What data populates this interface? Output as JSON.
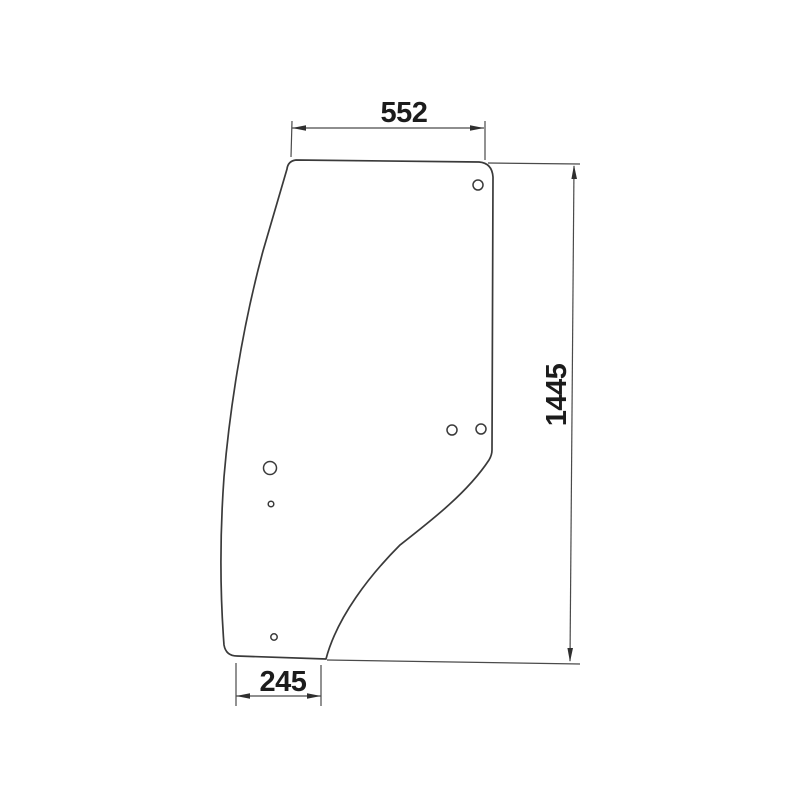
{
  "drawing": {
    "type": "technical-outline-drawing",
    "subject": "door-glass-panel",
    "dimensions": {
      "top_width": {
        "label": "552"
      },
      "height": {
        "label": "1445"
      },
      "bottom_width": {
        "label": "245"
      }
    },
    "holes": [
      {
        "name": "hole-top-right",
        "x": 478,
        "y": 185,
        "r": 5
      },
      {
        "name": "hole-mid-right-left",
        "x": 452,
        "y": 430,
        "r": 5
      },
      {
        "name": "hole-mid-right-right",
        "x": 481,
        "y": 429,
        "r": 5
      },
      {
        "name": "hole-left-large",
        "x": 270,
        "y": 468,
        "r": 6.5
      },
      {
        "name": "hole-left-small",
        "x": 271,
        "y": 504,
        "r": 2.8
      },
      {
        "name": "hole-bottom",
        "x": 274,
        "y": 637,
        "r": 3.2
      }
    ],
    "colors": {
      "background": "#ffffff",
      "outline": "#3a3a3a",
      "dimension_line": "#4a4a4a",
      "text": "#1c1c1c"
    }
  }
}
